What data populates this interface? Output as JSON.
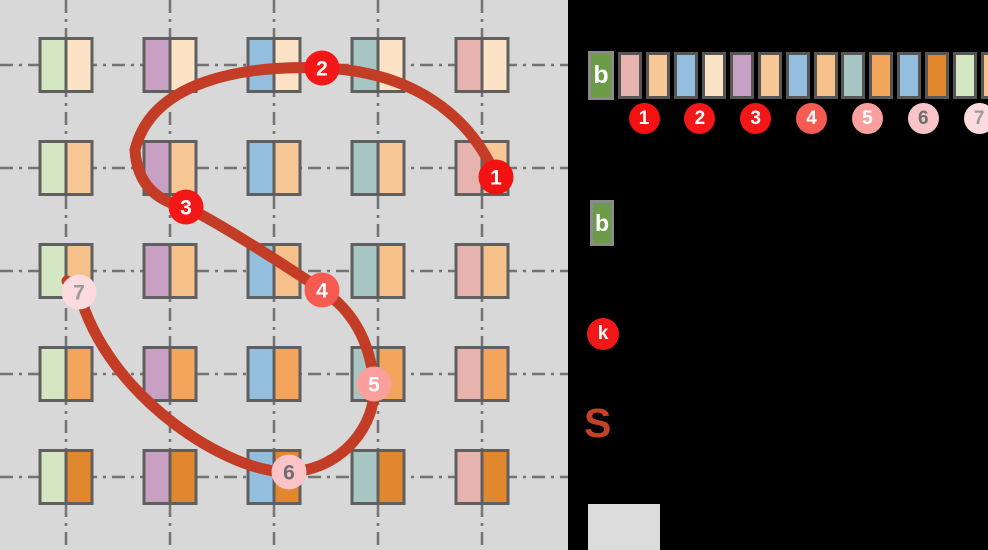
{
  "diagram": {
    "panel_bg": "#d8d8d8",
    "grid": {
      "columns_x": [
        66,
        170,
        274,
        378,
        482
      ],
      "rows_y": [
        65,
        168,
        271,
        374,
        477
      ],
      "column_colors": [
        "#d5e6c3",
        "#c7a0c3",
        "#93bedd",
        "#a6c5c3",
        "#e6b3ae"
      ],
      "row_colors": [
        "#fce3c6",
        "#f7c795",
        "#f5c08a",
        "#f2a55b",
        "#e1872d"
      ],
      "line_color": "#737373",
      "cell_border": "#5f5f5f",
      "cell_half_width": 26,
      "cell_height": 53
    },
    "path": {
      "color": "#c23c26",
      "stroke_width": 11,
      "d": "M 496 177 C 469 112 408 71 322 68 C 245 65 152 80 135 150 C 137 185 158 202 186 207 C 214 220 280 262 322 290 C 352 310 370 340 374 384 C 377 424 343 470 289 472 C 231 474 108 399 79 292",
      "end_nub": "M 79 292 L 67 281"
    },
    "markers": [
      {
        "label": "1",
        "x": 496,
        "y": 177,
        "fill": "#f21212",
        "text_color": "#ffffff"
      },
      {
        "label": "2",
        "x": 322,
        "y": 68,
        "fill": "#f41717",
        "text_color": "#ffffff"
      },
      {
        "label": "3",
        "x": 186,
        "y": 207,
        "fill": "#f41717",
        "text_color": "#ffffff"
      },
      {
        "label": "4",
        "x": 322,
        "y": 290,
        "fill": "#f75a51",
        "text_color": "#ffffff"
      },
      {
        "label": "5",
        "x": 374,
        "y": 384,
        "fill": "#fb9f9c",
        "text_color": "#ffffff"
      },
      {
        "label": "6",
        "x": 289,
        "y": 472,
        "fill": "#f9c3c8",
        "text_color": "#6e6e6e"
      },
      {
        "label": "7",
        "x": 79,
        "y": 292,
        "fill": "#fcdbdf",
        "text_color": "#9a9a9a"
      }
    ],
    "marker_radius": 17.5
  },
  "sequence": {
    "b_label": "b",
    "b_fill": "#6d9c49",
    "b_border": "#8a8a8a",
    "box_border": "#565656",
    "boxes": [
      "#e6b3ae",
      "#f7c795",
      "#93bedd",
      "#fce3c6",
      "#c7a0c3",
      "#f7c795",
      "#93bedd",
      "#f5c08a",
      "#a6c5c3",
      "#f2a55b",
      "#93bedd",
      "#e1872d",
      "#d5e6c3",
      "#f5c08a"
    ]
  },
  "legend": {
    "b_label": "b",
    "b_fill": "#6d9c49",
    "k_label": "k",
    "k_fill": "#f41717",
    "s_label": "S",
    "s_color": "#c14227"
  }
}
